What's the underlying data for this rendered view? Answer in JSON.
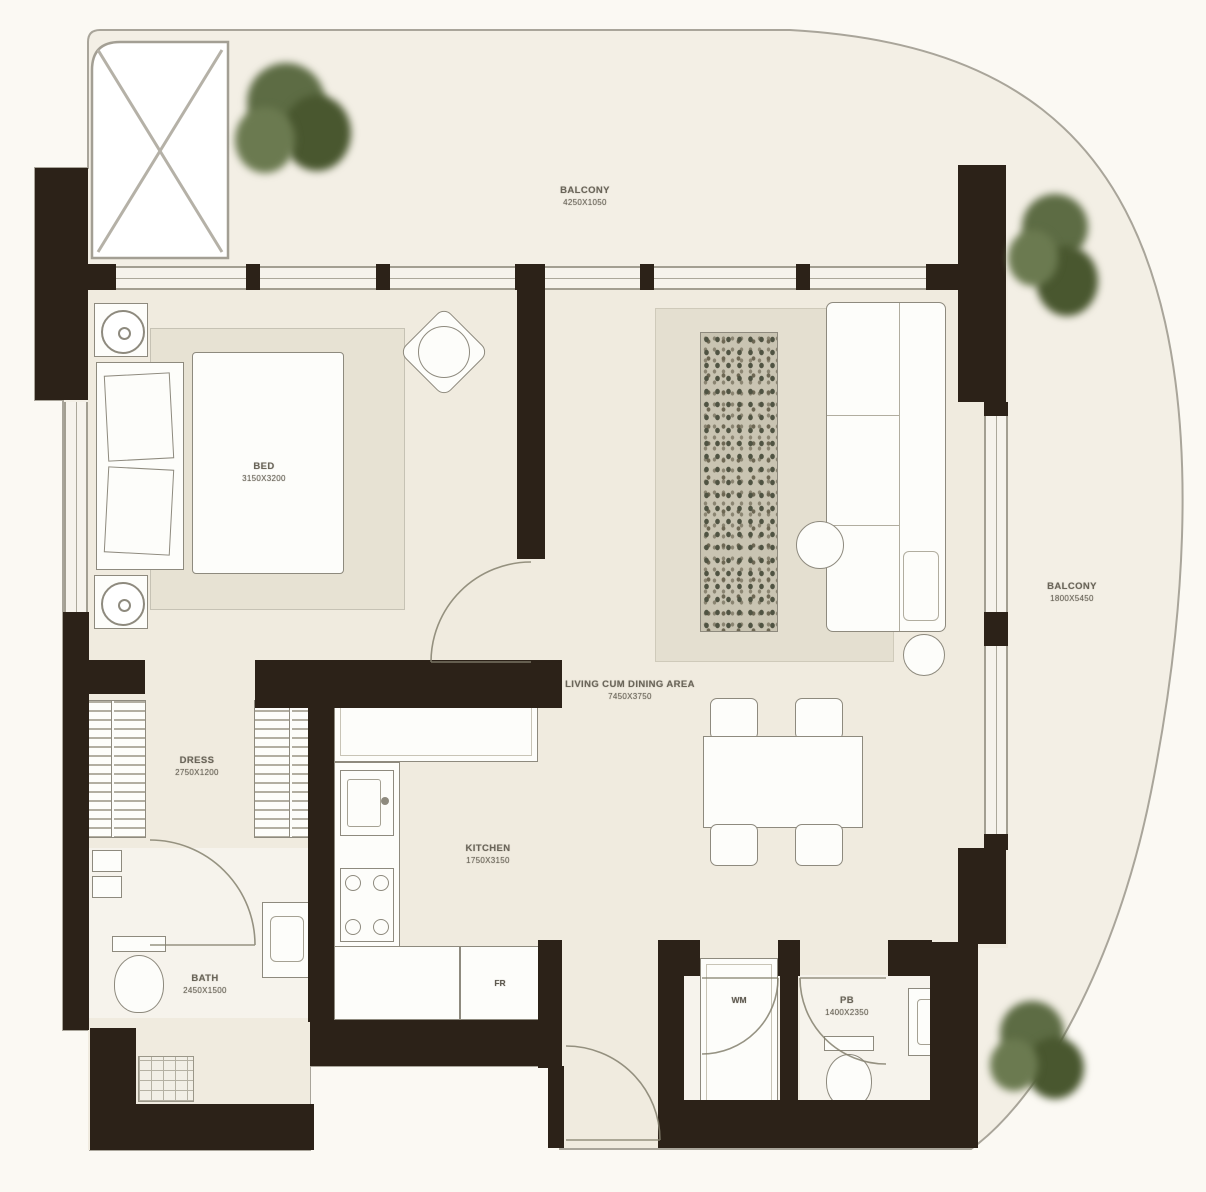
{
  "plan_title": "apartment-floor-plan",
  "colors": {
    "wall": "#2c2218",
    "interior_floor": "#f0ebdf",
    "balcony_floor": "#f3efe5",
    "wet_floor": "#f6f3ec",
    "outline": "#a9a59a",
    "furniture_stroke": "#8e8a7e",
    "rug": "#e4dfd0",
    "plant_green": "#5d6c44",
    "label_text": "#6a6559"
  },
  "rooms": {
    "balcony_top": {
      "label": "BALCONY",
      "dims": "4250X1050"
    },
    "bedroom": {
      "label": "BED",
      "dims": "3150X3200"
    },
    "living": {
      "label": "LIVING CUM DINING AREA",
      "dims": "7450X3750"
    },
    "kitchen": {
      "label": "KITCHEN",
      "dims": "1750X3150"
    },
    "dress": {
      "label": "DRESS",
      "dims": "2750X1200"
    },
    "bath": {
      "label": "BATH",
      "dims": "2450X1500"
    },
    "powder": {
      "label": "PB",
      "dims": "1400X2350"
    },
    "balcony_right": {
      "label": "BALCONY",
      "dims": "1800X5450"
    }
  },
  "appliances": {
    "fridge": "FR",
    "washing_machine": "WM"
  }
}
